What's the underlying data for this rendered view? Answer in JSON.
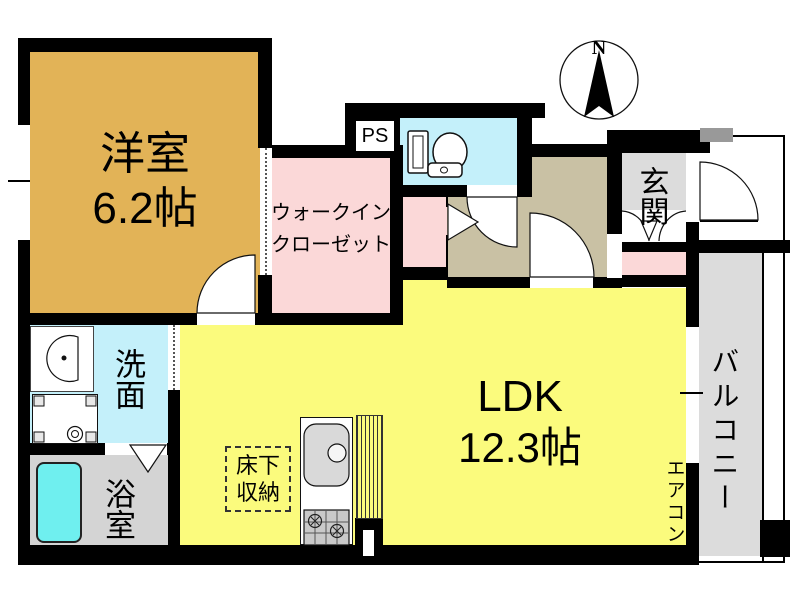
{
  "compass": {
    "north_label": "N"
  },
  "rooms": {
    "western_room": {
      "name": "洋室",
      "size": "6.2帖"
    },
    "walk_in_closet": {
      "name_line1": "ウォークイン",
      "name_line2": "クローゼット"
    },
    "pipe_space": {
      "name": "PS"
    },
    "entrance": {
      "name": "玄関"
    },
    "balcony": {
      "name": "バルコニー"
    },
    "ldk": {
      "name": "LDK",
      "size": "12.3帖"
    },
    "air_conditioner": {
      "name": "エアコン"
    },
    "underfloor_storage": {
      "name_line1": "床下",
      "name_line2": "収納"
    },
    "washroom": {
      "name": "洗面"
    },
    "bathroom": {
      "name": "浴室"
    }
  },
  "colors": {
    "wall": "#000000",
    "western_room": "#e2b357",
    "walk_in_closet": "#fbd8d8",
    "closet": "#fbd8d8",
    "toilet_room": "#c4f0fa",
    "washroom": "#c4f0fa",
    "hallway": "#c9c1a4",
    "entrance": "#dcdcdc",
    "balcony": "#dcdcdc",
    "bathroom": "#d4d4d4",
    "bathtub": "#6fefef",
    "ldk": "#fbfb7d",
    "meter_box": "#999999"
  }
}
